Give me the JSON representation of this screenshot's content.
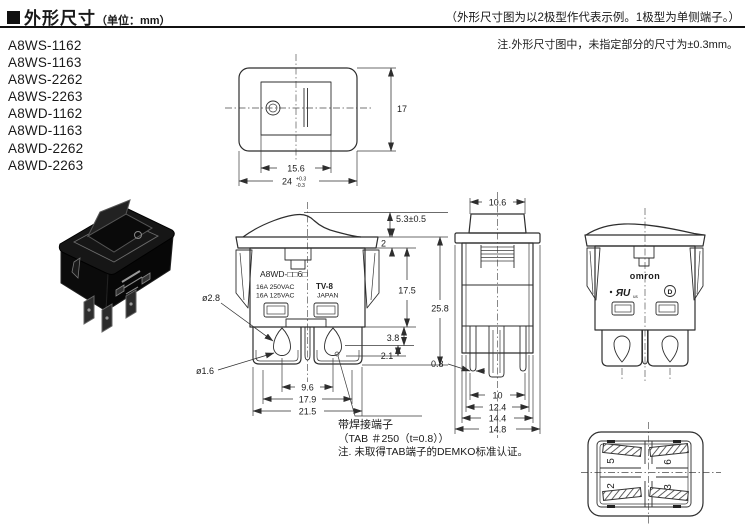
{
  "header": {
    "title": "外形尺寸",
    "unit": "（单位：mm）",
    "representation_note": "（外形尺寸图为以2极型作代表示例。1极型为单侧端子。）",
    "tolerance_note": "注.外形尺寸图中，未指定部分的尺寸为±0.3mm。"
  },
  "models": [
    "A8WS-1162",
    "A8WS-1163",
    "A8WS-2262",
    "A8WS-2263",
    "A8WD-1162",
    "A8WD-1163",
    "A8WD-2262",
    "A8WD-2263"
  ],
  "top_view": {
    "height": "17",
    "rocker_width": "15.6",
    "bezel_width": "24",
    "bezel_width_tol_plus": "+0.3",
    "bezel_width_tol_minus": "-0.3"
  },
  "front_view": {
    "marking_model": "A8WD-□□6□",
    "marking_rating_1": "16A 250VAC",
    "marking_rating_2": "16A 125VAC",
    "marking_tv": "TV-8",
    "marking_origin": "JAPAN",
    "dim_hole_dia": "ø2.8",
    "dim_small_dia": "ø1.6",
    "dim_actuator_height": "5.3±0.5",
    "dim_flange_thickness": "2",
    "dim_body_height": "17.5",
    "dim_total_height": "25.8",
    "dim_hole_offset_1": "3.8",
    "dim_hole_offset_2": "2.1",
    "dim_terminal_pitch": "9.6",
    "dim_width_mid": "17.9",
    "dim_width_outer": "21.5"
  },
  "side_view": {
    "dim_rocker_width": "10.6",
    "dim_tab_thickness": "0.8",
    "dim_w1": "10",
    "dim_w2": "12.4",
    "dim_w3": "14.4",
    "dim_w4": "14.8"
  },
  "rear_view": {
    "logo": "omron",
    "ul_mark": "ЯU",
    "ul_suffix": "us",
    "demko_mark": "D"
  },
  "bottom_view": {
    "terminal_1": "5",
    "terminal_2": "6",
    "terminal_3": "2",
    "terminal_4": "3"
  },
  "tab_note": {
    "label": "带焊接端子",
    "spec": "（TAB ＃250（t=0.8））",
    "note": "注. 未取得TAB端子的DEMKO标准认证。"
  }
}
